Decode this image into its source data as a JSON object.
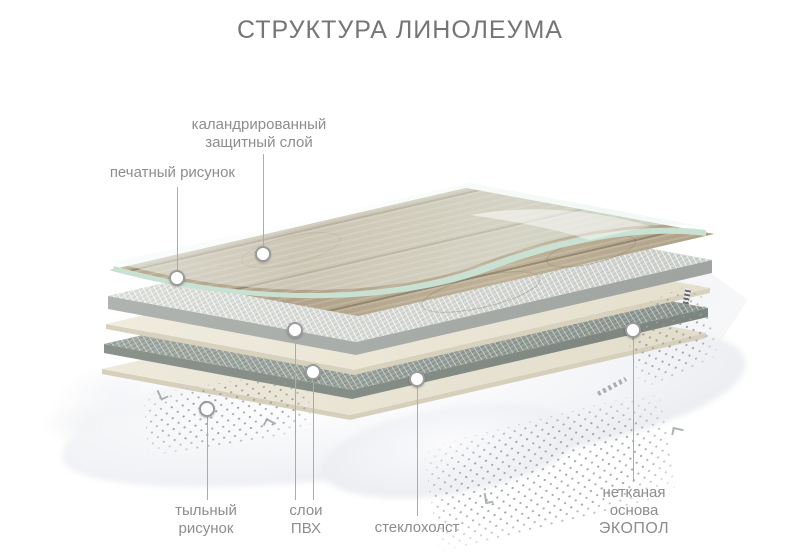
{
  "title": "СТРУКТУРА ЛИНОЛЕУМА",
  "callouts": {
    "protective": {
      "line1": "каландрированный",
      "line2": "защитный слой"
    },
    "printed_pattern": {
      "line1": "печатный рисунок"
    },
    "back_pattern": {
      "line1": "тыльный",
      "line2": "рисунок"
    },
    "pvc_layers": {
      "line1": "слои",
      "line2": "ПВХ"
    },
    "glass_fiber": {
      "line1": "стеклохолст"
    },
    "nonwoven_base": {
      "line1": "нетканая",
      "line2": "основа",
      "line3": "ЭКОПОЛ"
    }
  },
  "colors": {
    "title_text": "#757575",
    "label_text": "#8d8d8d",
    "leader_line": "#ababab",
    "marker_ring": "#9b9b9b",
    "wood": "#b2a58b",
    "protective_edge": "#c9e1d3",
    "fiber_light": "#d9dbd7",
    "fiber_dark": "#9aa39d",
    "cream_sheet": "#ece7d8",
    "nonwoven_white": "#f2f3f6",
    "dot_pattern": "#8f9698"
  }
}
